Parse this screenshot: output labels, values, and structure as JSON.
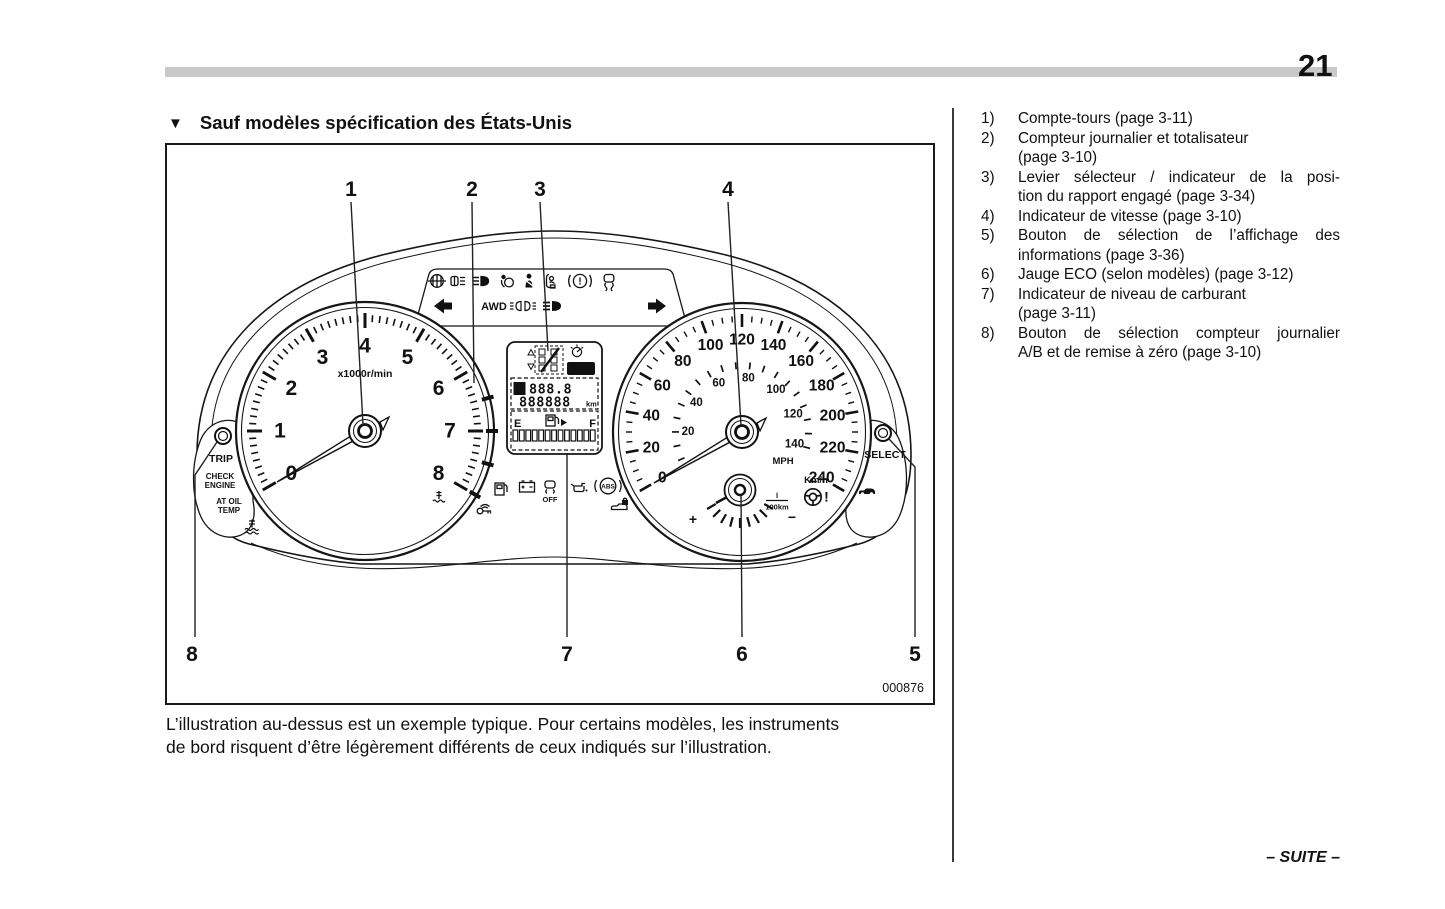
{
  "page": {
    "number": "21"
  },
  "section": {
    "marker": "▼",
    "title": "Sauf modèles spécification des États-Unis"
  },
  "figure": {
    "code": "000876",
    "callouts": [
      "1",
      "2",
      "3",
      "4",
      "5",
      "6",
      "7",
      "8"
    ],
    "caption_lines": [
      "L’illustration au-dessus est un exemple typique. Pour certains modèles, les instruments",
      "de bord risquent d’être légèrement différents de ceux indiqués sur l’illustration."
    ]
  },
  "legend": {
    "items": [
      {
        "num": "1)",
        "lines": [
          {
            "text": "Compte-tours (page 3-11)",
            "fit": false
          }
        ]
      },
      {
        "num": "2)",
        "lines": [
          {
            "text": "Compteur journalier et totalisateur",
            "fit": false
          },
          {
            "text": "(page 3-10)",
            "fit": false
          }
        ]
      },
      {
        "num": "3)",
        "lines": [
          {
            "text": "Levier sélecteur / indicateur de la posi-",
            "fit": true
          },
          {
            "text": "tion du rapport engagé (page 3-34)",
            "fit": false
          }
        ]
      },
      {
        "num": "4)",
        "lines": [
          {
            "text": "Indicateur de vitesse (page 3-10)",
            "fit": false
          }
        ]
      },
      {
        "num": "5)",
        "lines": [
          {
            "text": "Bouton de sélection de l’affichage des",
            "fit": true
          },
          {
            "text": "informations (page 3-36)",
            "fit": false
          }
        ]
      },
      {
        "num": "6)",
        "lines": [
          {
            "text": "Jauge ECO (selon modèles) (page 3-12)",
            "fit": false
          }
        ]
      },
      {
        "num": "7)",
        "lines": [
          {
            "text": "Indicateur de niveau de carburant",
            "fit": false
          },
          {
            "text": "(page 3-11)",
            "fit": false
          }
        ]
      },
      {
        "num": "8)",
        "lines": [
          {
            "text": "Bouton de sélection compteur journalier",
            "fit": true
          },
          {
            "text": "A/B et de remise à zéro (page 3-10)",
            "fit": false
          }
        ]
      }
    ]
  },
  "cluster": {
    "tachometer": {
      "unit": "x1000r/min",
      "numbers": [
        "0",
        "1",
        "2",
        "3",
        "4",
        "5",
        "6",
        "7",
        "8"
      ]
    },
    "speedometer": {
      "outer_unit": "Km/h",
      "outer_numbers": [
        "0",
        "20",
        "40",
        "60",
        "80",
        "100",
        "120",
        "140",
        "160",
        "180",
        "200",
        "220",
        "240"
      ],
      "inner_unit": "MPH",
      "inner_numbers": [
        "20",
        "40",
        "60",
        "80",
        "100",
        "120",
        "140"
      ]
    },
    "eco_gauge": {
      "plus": "+",
      "minus": "−",
      "consumption_numerator": "l",
      "consumption_denominator": "100km"
    },
    "display": {
      "set_badge": "SET",
      "trip_selector": "A",
      "trip_value": "888.8",
      "odometer_value": "888888",
      "odometer_unit": "km",
      "fuel_empty": "E",
      "fuel_full": "F"
    },
    "buttons": {
      "trip": "TRIP",
      "select": "SELECT"
    },
    "warning_texts": {
      "check_engine": [
        "CHECK",
        "ENGINE"
      ],
      "at_oil_temp": [
        "AT OIL",
        "TEMP"
      ],
      "awd": "AWD",
      "vdc_off": "OFF",
      "abs": "ABS"
    },
    "indicator_icons": {
      "top_row": [
        "front-fog-light-icon",
        "rear-fog-light-icon",
        "headlight-warning-icon",
        "airbag-warning-icon",
        "seatbelt-reminder-icon",
        "front-passenger-occupant-icon",
        "brake-warning-icon",
        "vehicle-dynamics-control-icon"
      ],
      "signal_row": [
        "turn-signal-left-icon",
        "awd-indicator",
        "tail-light-indicator-icon",
        "high-beam-indicator-icon",
        "turn-signal-right-icon"
      ],
      "lower_row": [
        "coolant-temperature-icon",
        "fuel-warning-icon",
        "charge-warning-icon",
        "vdc-off-indicator",
        "oil-pressure-icon",
        "abs-warning-icon",
        "immobilizer-icon",
        "security-indicator-icon"
      ],
      "left_pod": [
        "trip-button",
        "oil-temperature-warning-icon"
      ],
      "right_pod": [
        "select-button",
        "door-open-icon"
      ],
      "inside_speedometer": [
        "power-steering-warning-icon"
      ]
    }
  },
  "footer": {
    "suite": "– SUITE –"
  }
}
